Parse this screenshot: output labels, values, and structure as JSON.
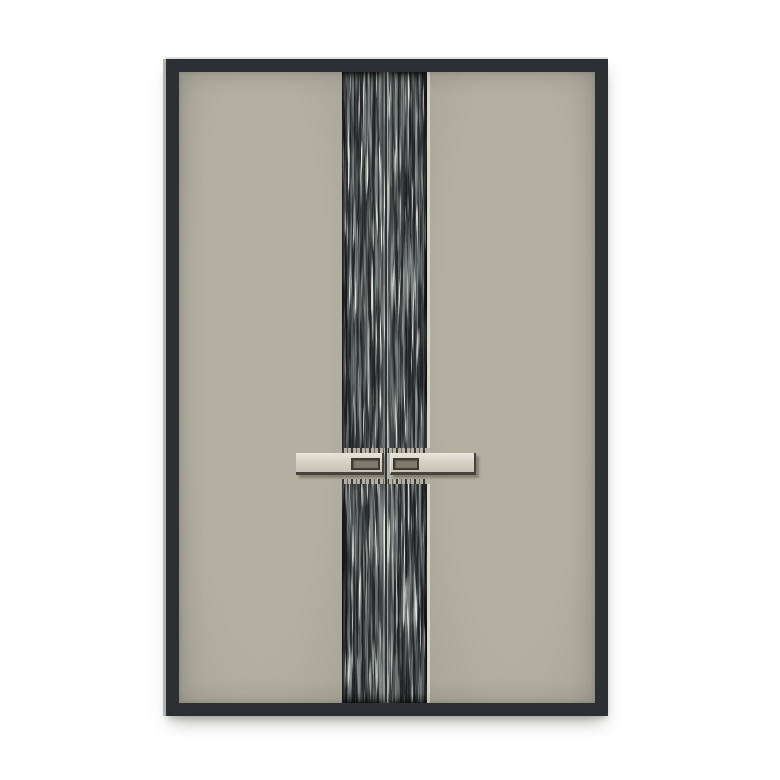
{
  "scene": {
    "subject": "Modern double entry door: dark charcoal frame, warm gray panels, central vertical ripple-textured band split by the door gap, and a pair of horizontal bar handles with recessed grip plates"
  },
  "colors": {
    "background": "#ffffff",
    "frame": "#2d3032",
    "frame_highlight": "#b2b2ae",
    "panel": "#b3b0a2",
    "panel_deep": "#a9a699",
    "texture_base": "#26292b",
    "texture_mid": "#77817f",
    "texture_light": "#e2e3dd",
    "strip_sliver": "#d8d6c8",
    "gap_line": "#2f3336",
    "handle_face": "#d6d2c4",
    "handle_face_light": "#e9e6db",
    "handle_face_dark": "#c6c2b4",
    "handle_edge": "#45433b",
    "inset_fill": "#7f7b6c",
    "inset_border": "#3e3c35"
  }
}
